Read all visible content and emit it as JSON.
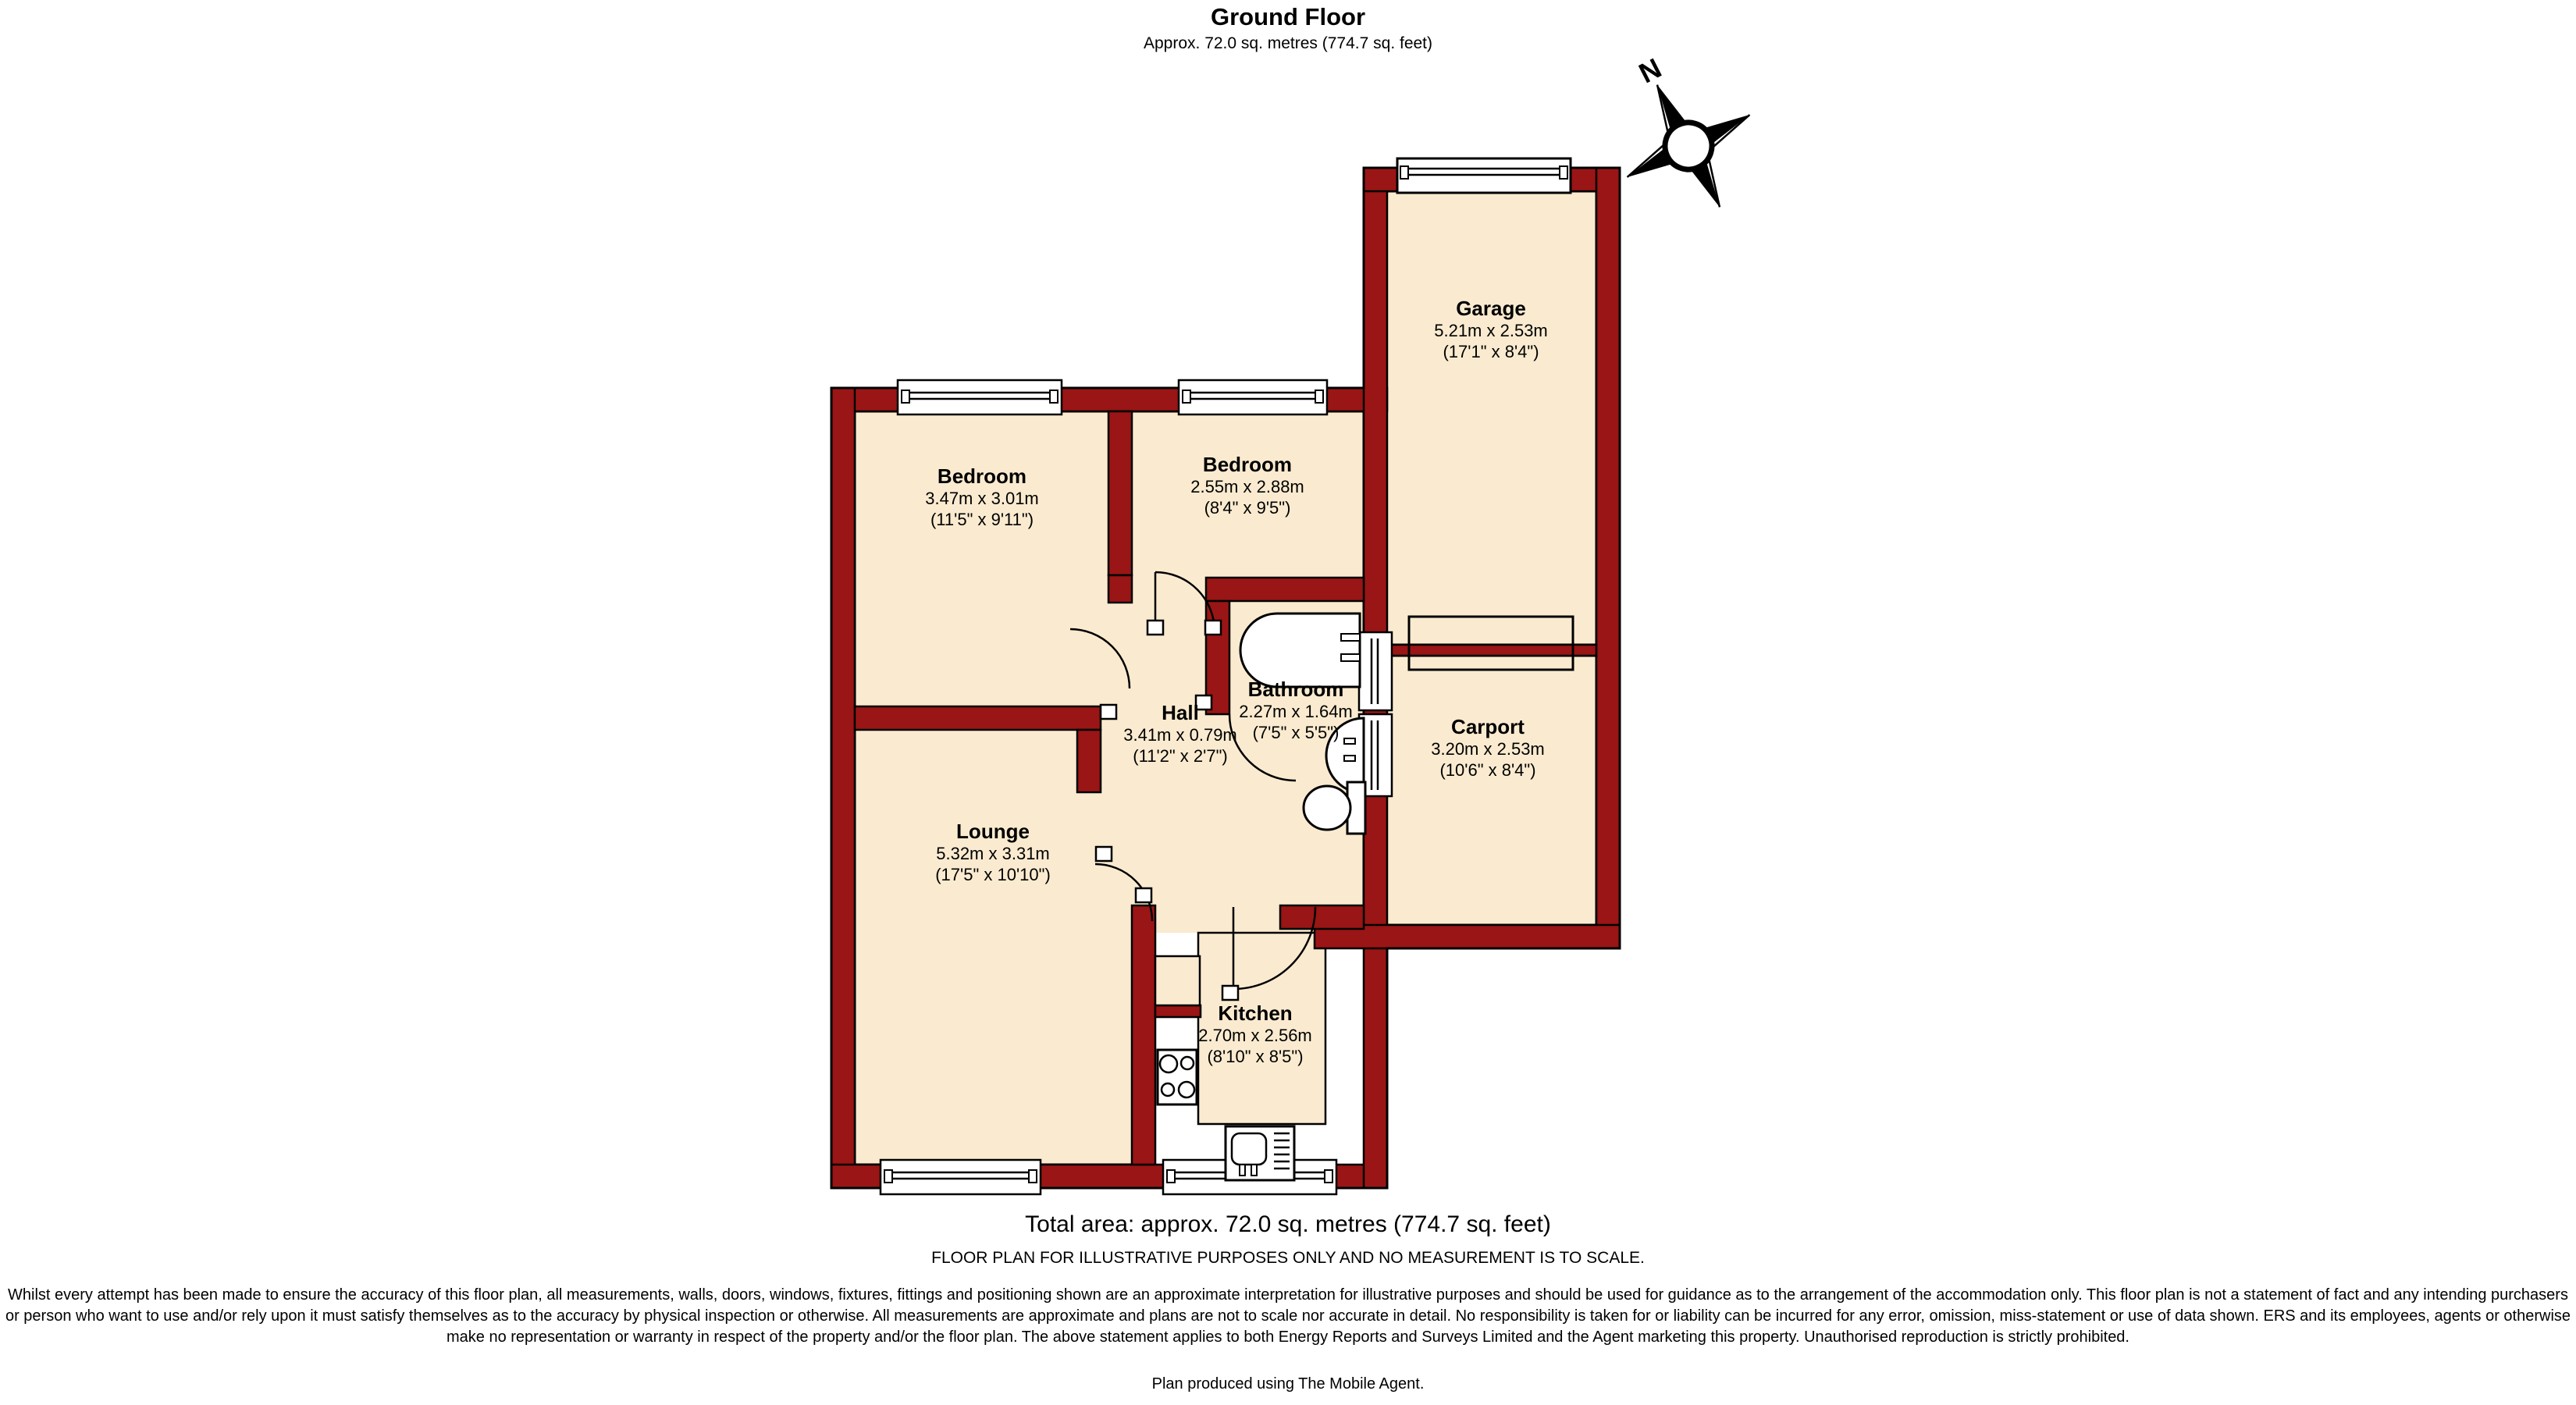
{
  "header": {
    "title": "Ground Floor",
    "subtitle": "Approx.  72.0 sq. metres (774.7 sq. feet)"
  },
  "compass": {
    "north_label": "N"
  },
  "rooms": [
    {
      "id": "bedroom1",
      "name": "Bedroom",
      "metric": "3.47m x 3.01m",
      "imperial": "(11'5\" x 9'11\")"
    },
    {
      "id": "bedroom2",
      "name": "Bedroom",
      "metric": "2.55m x 2.88m",
      "imperial": "(8'4\" x 9'5\")"
    },
    {
      "id": "garage",
      "name": "Garage",
      "metric": "5.21m x 2.53m",
      "imperial": "(17'1\" x 8'4\")"
    },
    {
      "id": "bathroom",
      "name": "Bathroom",
      "metric": "2.27m x 1.64m",
      "imperial": "(7'5\" x 5'5\")"
    },
    {
      "id": "hall",
      "name": "Hall",
      "metric": "3.41m x 0.79m",
      "imperial": "(11'2\" x 2'7\")"
    },
    {
      "id": "carport",
      "name": "Carport",
      "metric": "3.20m x 2.53m",
      "imperial": "(10'6\" x 8'4\")"
    },
    {
      "id": "lounge",
      "name": "Lounge",
      "metric": "5.32m x 3.31m",
      "imperial": "(17'5\" x 10'10\")"
    },
    {
      "id": "kitchen",
      "name": "Kitchen",
      "metric": "2.70m x 2.56m",
      "imperial": "(8'10\" x 8'5\")"
    }
  ],
  "footer": {
    "total_area": "Total area: approx.  72.0 sq. metres (774.7 sq. feet)",
    "scale_note": "FLOOR PLAN FOR ILLUSTRATIVE PURPOSES ONLY AND NO MEASUREMENT IS TO SCALE.",
    "disclaimer": "Whilst every attempt has been made to ensure the accuracy of this floor plan, all measurements, walls, doors, windows, fixtures, fittings and positioning shown are an approximate interpretation for illustrative purposes and should be used for guidance as to the arrangement of the accommodation only. This floor plan is not a statement of fact and any intending purchasers or person who want to use and/or rely upon it must satisfy themselves as to the accuracy by physical inspection or otherwise. All measurements are approximate and plans are not to scale nor accurate in detail.  No responsibility is taken for or liability can be incurred for any error, omission, miss-statement or use of data shown. ERS and its employees, agents or otherwise make no representation or warranty in respect of the property and/or the floor plan. The above statement applies to both Energy Reports and Surveys Limited and the Agent marketing this property. Unauthorised reproduction is strictly prohibited.",
    "credit": "Plan produced using The Mobile Agent."
  },
  "colors": {
    "wall": "#9a1515",
    "floor": "#faebd0",
    "outline": "#000000"
  }
}
